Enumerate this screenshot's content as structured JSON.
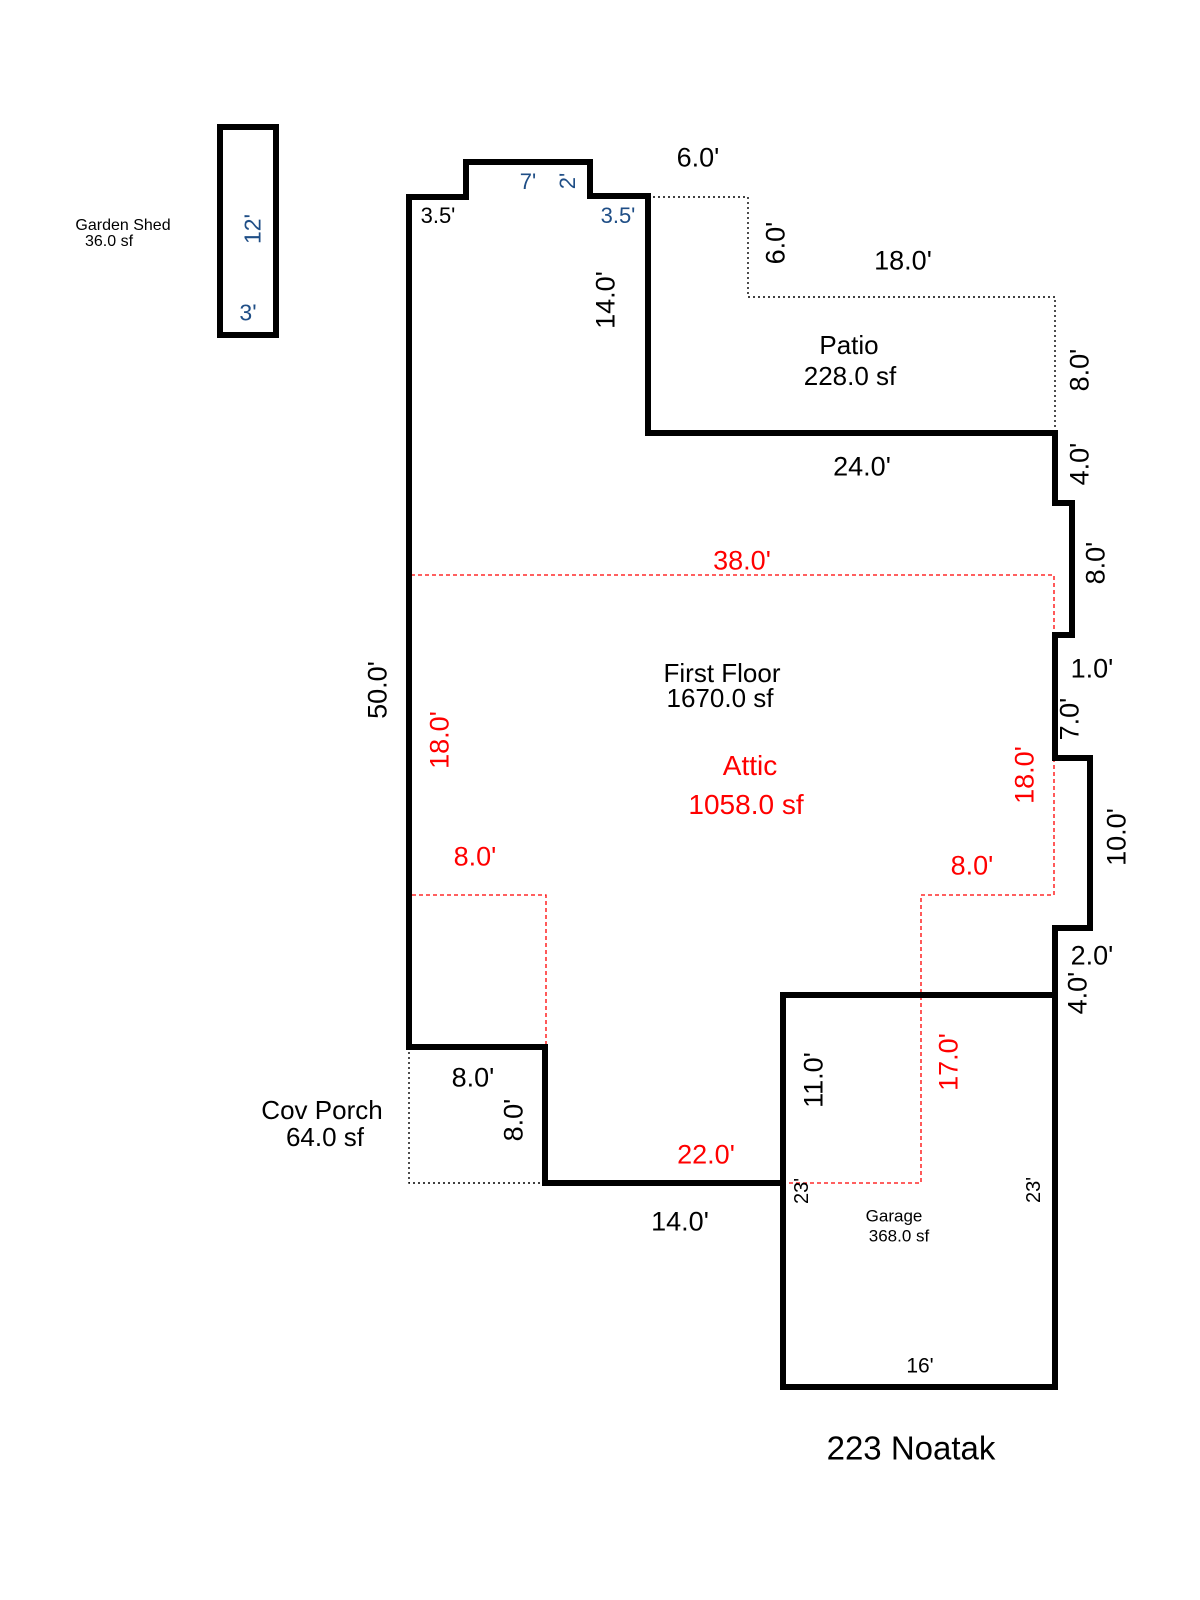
{
  "address": "223 Noatak",
  "colors": {
    "wall": "#000000",
    "attic_line": "#ff0000",
    "secondary_dim": "#1f4e86"
  },
  "areas": {
    "shed": {
      "name": "Garden Shed",
      "sf": "36.0 sf"
    },
    "patio": {
      "name": "Patio",
      "sf": "228.0 sf"
    },
    "first_floor": {
      "name": "First Floor",
      "sf": "1670.0 sf"
    },
    "attic": {
      "name": "Attic",
      "sf": "1058.0 sf"
    },
    "porch": {
      "name": "Cov Porch",
      "sf": "64.0 sf"
    },
    "garage": {
      "name": "Garage",
      "sf": "368.0 sf"
    }
  },
  "dims": {
    "top_left_offset": "3.5'",
    "bump_width": "7'",
    "bump_depth": "2'",
    "top_right_offset": "3.5'",
    "patio_top": "6.0'",
    "patio_inset": "6.0'",
    "patio_top_width": "18.0'",
    "patio_right": "8.0'",
    "wing_wall": "14.0'",
    "patio_bottom": "24.0'",
    "right_wall_4a": "4.0'",
    "right_wall_8": "8.0'",
    "right_step_1": "1.0'",
    "right_wall_7": "7.0'",
    "right_wall_10": "10.0'",
    "right_step_2": "2.0'",
    "right_wall_4b": "4.0'",
    "left_wall": "50.0'",
    "attic_top": "38.0'",
    "attic_left": "18.0'",
    "attic_right": "18.0'",
    "attic_left_inset": "8.0'",
    "attic_right_inset": "8.0'",
    "attic_bottom": "22.0'",
    "attic_right_lower": "17.0'",
    "porch_top": "8.0'",
    "porch_side": "8.0'",
    "bottom_wall": "14.0'",
    "garage_wall_upper": "11.0'",
    "garage_left": "23'",
    "garage_right": "23'",
    "garage_bottom": "16'",
    "shed_long": "12'",
    "shed_short": "3'"
  }
}
